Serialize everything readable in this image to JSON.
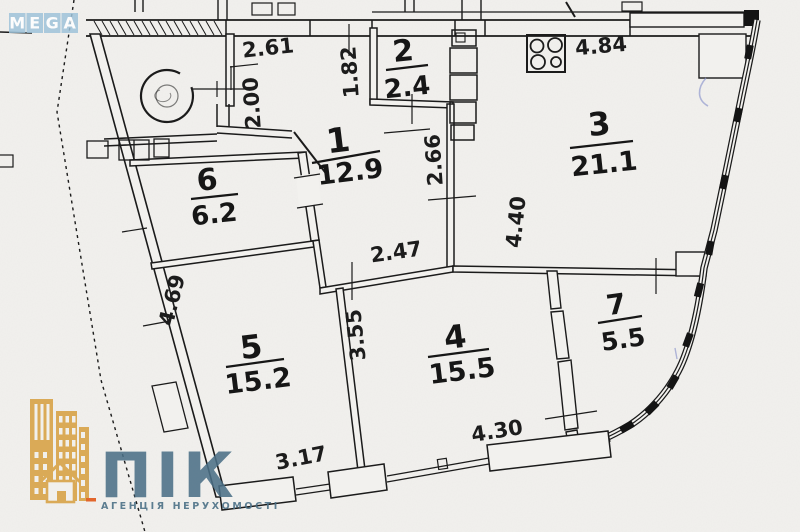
{
  "watermark": {
    "letters": [
      "M",
      "E",
      "G",
      "A"
    ]
  },
  "plan": {
    "rooms": [
      {
        "number": "1",
        "area": "12.9"
      },
      {
        "number": "2",
        "area": "2.4"
      },
      {
        "number": "3",
        "area": "21.1"
      },
      {
        "number": "4",
        "area": "15.5"
      },
      {
        "number": "5",
        "area": "15.2"
      },
      {
        "number": "6",
        "area": "6.2"
      },
      {
        "number": "7",
        "area": "5.5"
      }
    ],
    "dimensions": [
      {
        "value": "2.61"
      },
      {
        "value": "2.00"
      },
      {
        "value": "1.82"
      },
      {
        "value": "2.66"
      },
      {
        "value": "4.84"
      },
      {
        "value": "2.47"
      },
      {
        "value": "4.40"
      },
      {
        "value": "4.69"
      },
      {
        "value": "3.55"
      },
      {
        "value": "3.17"
      },
      {
        "value": "4.30"
      }
    ],
    "colors": {
      "ink": "#1b1b1b",
      "paper": "#f2f1ee",
      "pen_mark": "#8a94cc"
    }
  },
  "logo": {
    "title": "ПІК",
    "subtitle": "АГЕНЦІЯ НЕРУХОМОСТІ",
    "colors": {
      "text": "#4b7086",
      "building": "#d9a54c",
      "accent": "#e2662c"
    }
  }
}
